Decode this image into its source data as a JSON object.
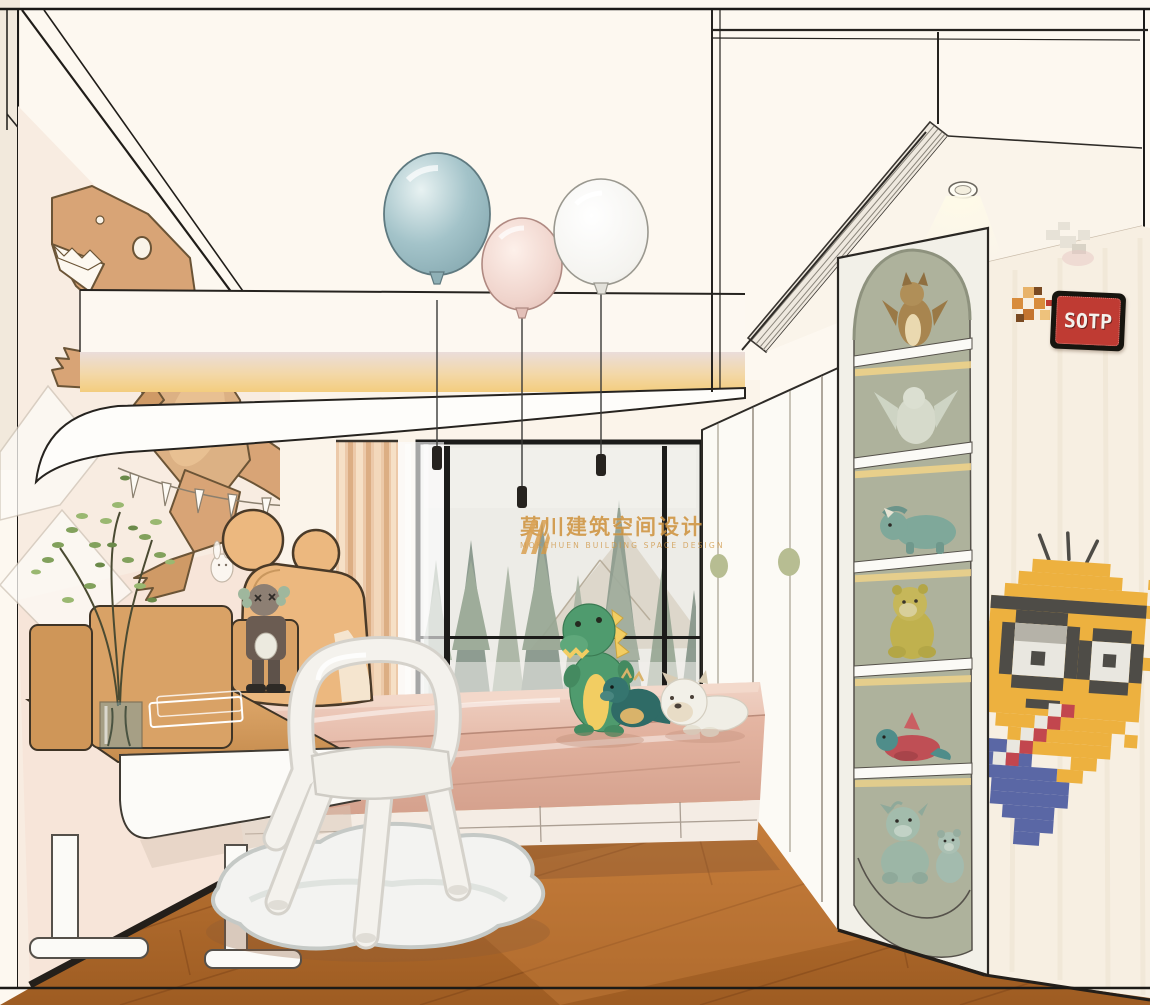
{
  "watermark": {
    "cn": "莫川建筑空间设计",
    "en": "MOKCHUEN BUILDING SPACE DESIGN"
  },
  "sign": {
    "stop": "SOTP"
  },
  "palette": {
    "watermark_orange": "#cf9440",
    "sign_red": "#bf3b33",
    "wall_cream": "#f8efe3",
    "ceiling_white": "#fdf8f0",
    "glow_warm": "#f3d288",
    "wood_desk": "#d9a266",
    "wood_floor": "#b5722f",
    "bed_pink": "#e8c2b2",
    "curtain_peach": "#ecc9a9",
    "shelf_sage": "#b4b8a2",
    "balloon_blue": "#a3c3c9",
    "balloon_pink": "#f0d4cc",
    "balloon_white": "#f6f5f2",
    "minion_yellow": "#edb13f",
    "minion_blue": "#5a67a5",
    "dino_plush_green": "#4f9b6e",
    "wall_dino_tan": "#d8a476",
    "outline_ink": "#2a2723"
  }
}
